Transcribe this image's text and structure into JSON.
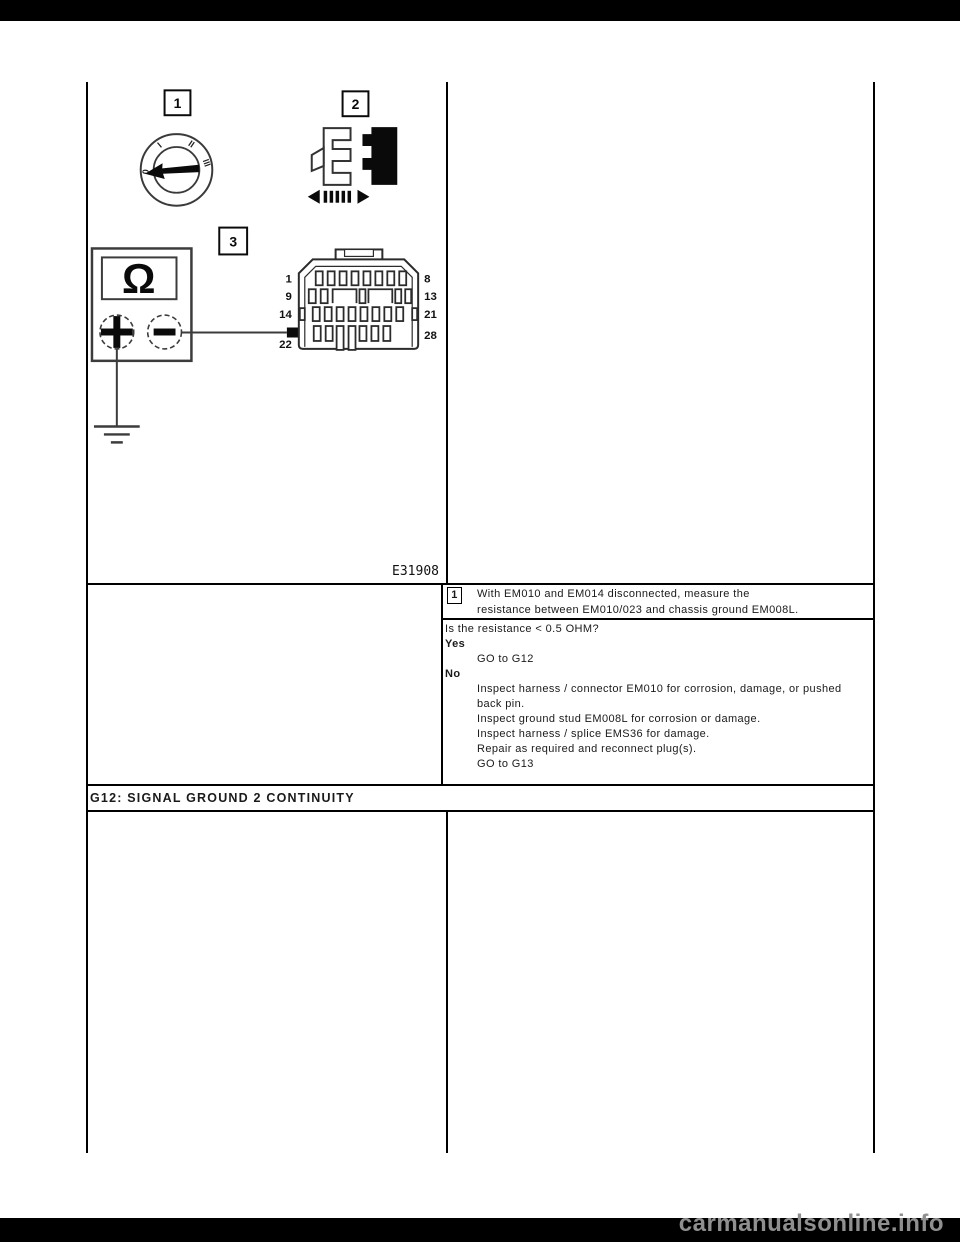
{
  "page": {
    "watermark": "carmanualsonline.info"
  },
  "figure": {
    "label": "E31908",
    "callouts": {
      "ignition": "1",
      "connector": "2",
      "meter": "3"
    },
    "ignition_positions": [
      "0",
      "I",
      "II",
      "III"
    ],
    "meter": {
      "display": "Ω",
      "plus": "+",
      "minus": "−"
    },
    "connector_pins": {
      "row1_left": "1",
      "row1_right": "8",
      "row2_left": "9",
      "row2_right": "13",
      "row3_left": "14",
      "row3_right": "21",
      "row4_left": "22",
      "row4_right": "28"
    }
  },
  "step": {
    "number": "1",
    "line1": "With EM010 and EM014 disconnected, measure the",
    "line2": "resistance between EM010/023 and chassis ground EM008L."
  },
  "decision": {
    "question": "Is the resistance < 0.5 OHM?",
    "yes_label": "Yes",
    "yes_action": "GO to G12",
    "no_label": "No",
    "no_actions": [
      "Inspect harness / connector EM010 for corrosion, damage, or pushed back pin.",
      "Inspect ground stud EM008L for corrosion or damage.",
      "Inspect harness / splice EMS36 for damage.",
      "Repair as required and reconnect plug(s).",
      "GO to G13"
    ]
  },
  "section_header": "G12: SIGNAL GROUND 2 CONTINUITY",
  "colors": {
    "border": "#000000",
    "watermark": "#8f8f8f",
    "bar": "#000000"
  }
}
